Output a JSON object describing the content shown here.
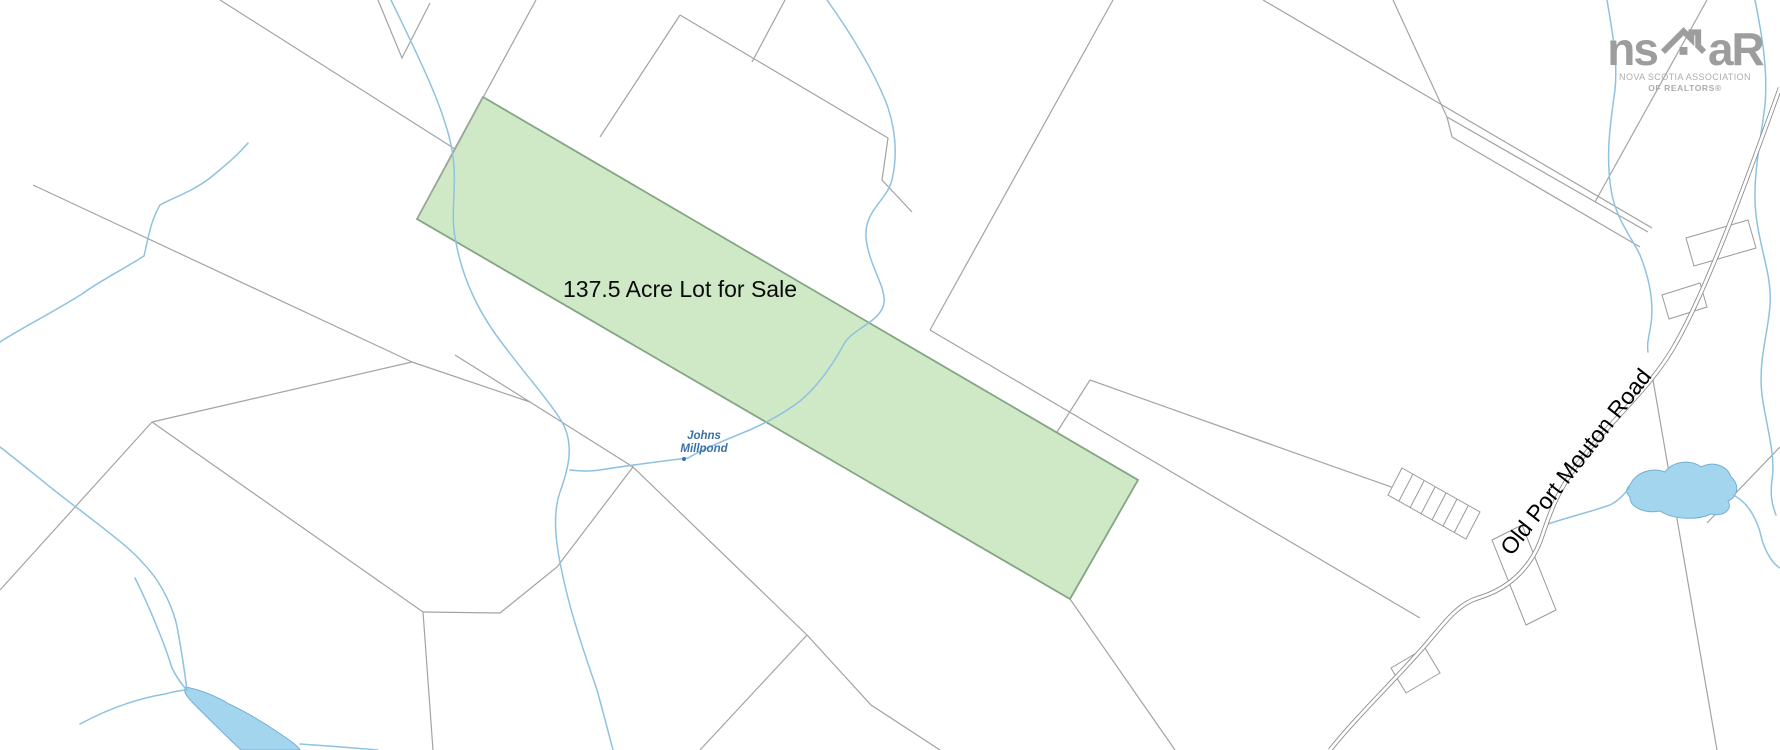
{
  "map": {
    "background": "#ffffff",
    "colors": {
      "parcel_line": "#a3a3a3",
      "highlight_fill": "#cfe9c6",
      "highlight_stroke": "#84a584",
      "stream": "#8fc2e0",
      "water_fill": "#a3d6ee",
      "water_stroke": "#74afd3",
      "road_casing": "#8f8f8f",
      "label_blue": "#3a70a8",
      "label_black": "#000000",
      "logo_gray": "#9d9d9d"
    },
    "labels": {
      "lot": {
        "text": "137.5 Acre Lot for Sale"
      },
      "pond": {
        "line1": "Johns",
        "line2": "Millpond"
      },
      "road": {
        "text": "Old Port Mouton Road"
      }
    },
    "logo": {
      "prefix": "ns",
      "suffix": "aR",
      "house_icon": "house-with-chimney",
      "line1": "NOVA SCOTIA ASSOCIATION",
      "line2": "OF REALTORS®"
    },
    "geometry": {
      "highlight": "M483,97 L1138,480 L1070,599 L417,219 Z",
      "parcel_lines": [
        "M536,0 L417,219",
        "M220,0 L455,149",
        "M680,15 L600,137",
        "M680,15 L888,138 L882,180 L912,212",
        "M785,0 L752,62",
        "M1113,0 L930,330",
        "M930,330 L1420,618",
        "M1263,0 L1652,228",
        "M1707,0 L1595,202",
        "M1447,117 L1648,232 M1452,137 L1640,247 M1447,117 L1452,137",
        "M1070,599 L1175,750",
        "M807,635 L633,467 L530,402 L455,355",
        "M633,467 L557,567 L500,613",
        "M807,635 L871,705 L940,750",
        "M807,635 L700,750",
        "M152,422 L0,590",
        "M152,422 L412,362",
        "M33,185 L412,362",
        "M412,362 L530,402",
        "M423,612 L152,422",
        "M423,612 L500,613",
        "M423,612 L433,750",
        "M378,0 L402,58 L430,3",
        "M1653,380 L1717,750",
        "M1780,447 L1707,523",
        "M1057,432 L1090,380",
        "M1090,380 L1250,437 L1428,500",
        "M1393,0 L1447,117"
      ],
      "streams": [
        "M391,0 C420,60 445,110 452,150 C458,185 450,210 455,237 C462,280 480,315 505,347 C530,380 550,402 562,422 C575,445 568,470 560,492 C552,515 556,545 562,572 C570,612 585,655 597,690 C604,715 609,735 613,750",
        "M827,0 C852,35 872,68 886,102 C897,132 897,158 892,180 C886,202 864,210 866,238 C869,266 886,286 884,303 C881,322 853,328 844,344 C832,366 818,386 800,401 C782,415 758,427 740,434 C720,442 700,451 688,458",
        "M688,458 C655,462 625,466 600,470 C588,472 578,471 570,470",
        "M248,143 C235,158 222,168 210,178 C190,193 172,198 160,205 C150,222 148,240 144,256 C122,270 98,282 82,294 C50,314 18,330 0,342",
        "M0,447 C30,470 55,492 80,510 C108,532 130,548 142,562 C158,578 170,600 176,622 C181,645 184,668 187,690",
        "M135,578 C150,608 165,645 172,668 C177,678 182,685 187,690",
        "M80,724 C110,708 140,698 165,694 C173,692 180,690 187,690",
        "M300,744 C330,746 355,748 378,750",
        "M1607,0 C1612,30 1618,60 1615,90 C1610,125 1605,160 1612,195 C1618,222 1632,238 1640,255 C1650,280 1655,305 1650,330 C1648,340 1647,345 1648,352",
        "M1755,0 C1762,35 1768,70 1765,105 C1760,145 1752,180 1756,215 C1760,250 1772,275 1770,305 C1768,335 1758,360 1762,395 C1766,425 1776,455 1772,480 C1770,495 1772,505 1776,515",
        "M1545,525 C1565,518 1590,512 1610,505 C1620,500 1626,492 1630,487",
        "M1733,495 C1748,502 1758,520 1762,540 C1768,558 1775,565 1780,568"
      ],
      "water": [
        "M1630,485 C1636,472 1652,467 1665,472 C1673,461 1691,459 1701,467 C1713,461 1727,465 1731,477 C1740,484 1738,497 1728,501 C1733,509 1724,517 1711,514 C1696,521 1672,519 1660,511 C1645,514 1629,507 1630,497 C1625,492 1626,489 1630,485 Z",
        "M186,687 C200,690 216,696 229,704 C246,712 263,722 279,733 C291,741 298,746 300,750 L241,750 C227,737 209,719 195,705 C187,697 182,691 186,687 Z"
      ],
      "road": "M1780,88 C1745,185 1705,295 1672,350 C1645,395 1600,430 1572,472 C1553,500 1548,520 1540,542 C1528,572 1505,590 1478,598 C1458,604 1445,622 1428,642 C1400,675 1358,715 1330,750",
      "lot_strip": "M1402,468 L1480,512 L1466,539 L1388,495 Z M1413,474 L1399,501 M1424,481 L1410,508 M1435,487 L1421,514 M1446,493 L1432,520 M1457,499 L1443,526 M1468,506 L1454,533",
      "buildings": [
        "M1686,238 L1748,220 L1756,248 L1694,266 Z",
        "M1662,295 L1700,283 L1707,307 L1669,319 Z",
        "M1391,668 L1425,648 L1440,673 L1406,693 Z",
        "M1492,540 L1522,525 L1556,610 L1526,625 Z"
      ]
    }
  }
}
